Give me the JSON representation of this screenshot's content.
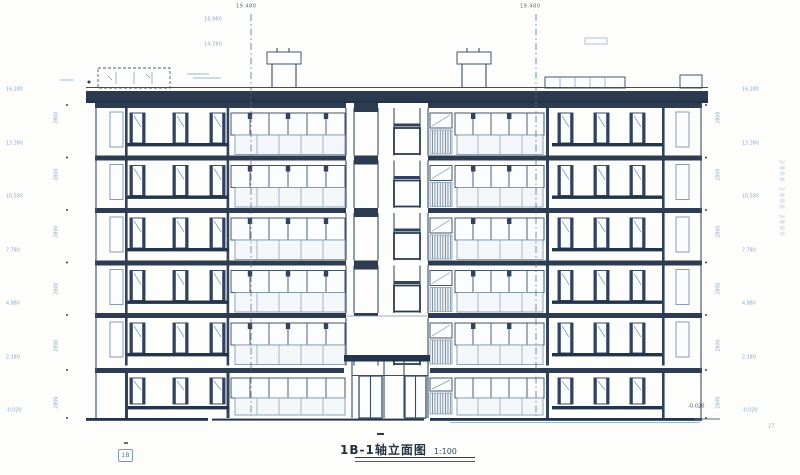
{
  "colors": {
    "ink": "#3a4d66",
    "heavy_band": "#2d3c51",
    "faint_blue": "#92abc7",
    "paper": "#fdfdfb"
  },
  "header": {
    "axis_label_left": "19.480",
    "axis_label_right": "19.480",
    "roof_note_top": "16.980",
    "roof_note_bottom": "14.780"
  },
  "dimensions": {
    "left": {
      "elevations": [
        "16.180",
        "13.380",
        "10.580",
        "7.780",
        "4.980",
        "2.180",
        "-0.020"
      ],
      "heights": [
        "2800",
        "2800",
        "2800",
        "2800",
        "2800",
        "2800"
      ]
    },
    "right": {
      "elevations": [
        "16.180",
        "13.380",
        "10.580",
        "7.780",
        "4.980",
        "2.180",
        "-0.020"
      ],
      "heights": [
        "2800",
        "2800",
        "2800",
        "2800",
        "2800",
        "2800"
      ]
    },
    "right_margin_column": "2800 2800 2800"
  },
  "footer": {
    "title": "1B-1轴立面图",
    "scale": "1:100",
    "axis_bubble": "1B",
    "base_elevation": "-0.020",
    "corner_note": "27"
  }
}
